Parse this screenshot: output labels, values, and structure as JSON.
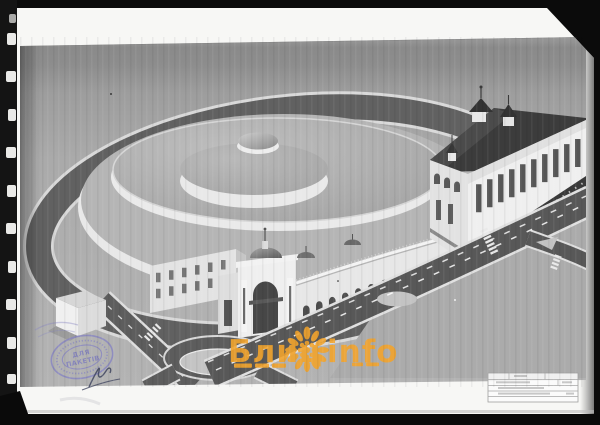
{
  "watermark": {
    "title_left": "Блиц",
    "title_right": "info",
    "color": "#f2a42d"
  },
  "stamp": {
    "line1": "ДЛЯ",
    "line2": "ПАКЕТІВ",
    "color": "#7d7cbe"
  },
  "colors": {
    "scanner_background": "#0b0b0b",
    "paper": "#f7f7f5",
    "render_sky": "#8f8f8f",
    "render_ground": "#b1b1b1",
    "road_asphalt": "#5d5d5d",
    "dark_roof": "#3c3c3c",
    "facade_white": "#efefef"
  }
}
